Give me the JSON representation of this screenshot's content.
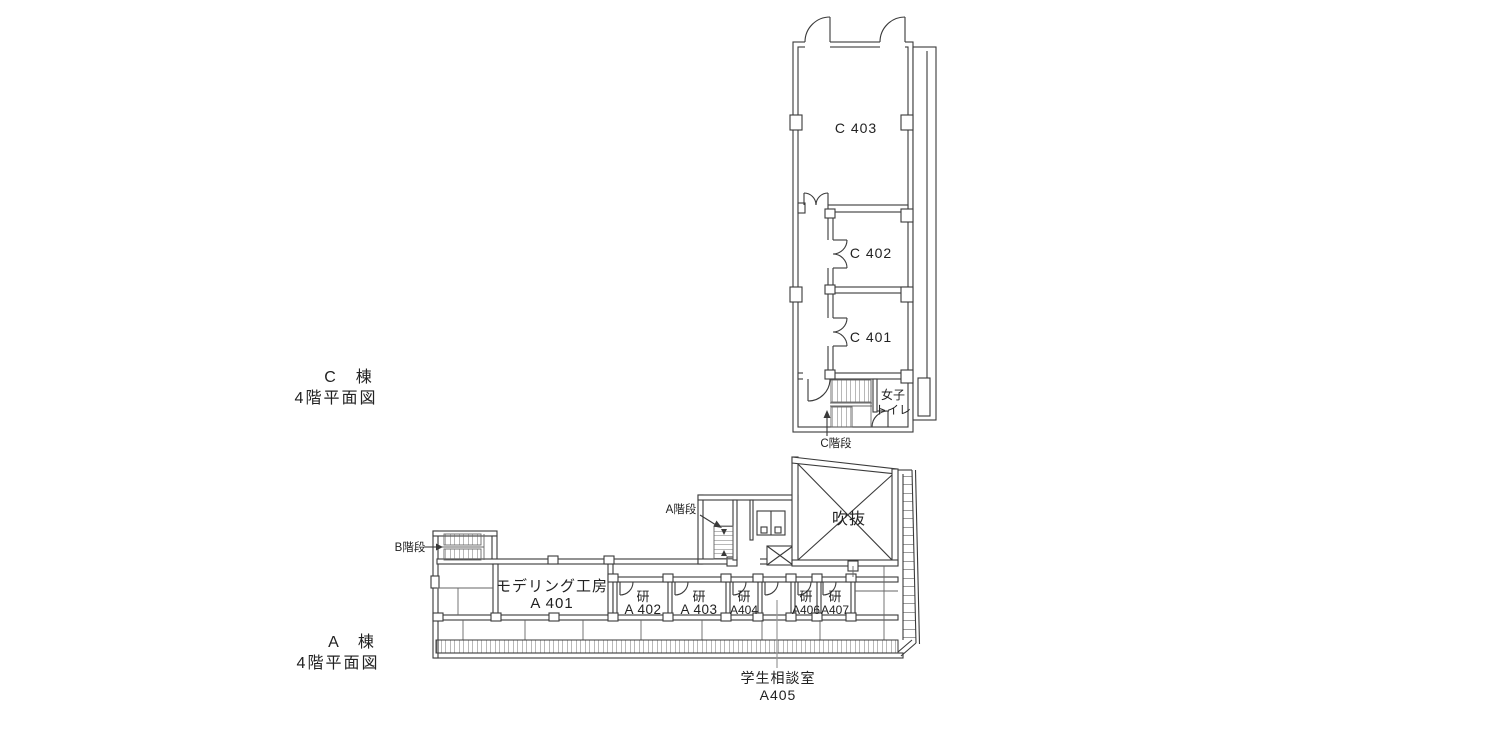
{
  "colors": {
    "background": "#ffffff",
    "wall_line": "#3a3a3a",
    "thin_line": "#666666",
    "leader_line": "#999999",
    "text": "#222222"
  },
  "c_wing": {
    "title_line1": "C　棟",
    "title_line2": "4階平面図",
    "rooms": [
      {
        "label": "C 403"
      },
      {
        "label": "C 402"
      },
      {
        "label": "C 401"
      }
    ],
    "toilet_line1": "女子",
    "toilet_line2": "トイレ",
    "stair_label": "C階段"
  },
  "a_wing": {
    "title_line1": "A　棟",
    "title_line2": "4階平面図",
    "modeling_line1": "モデリング工房",
    "modeling_line2": "A 401",
    "labs": [
      {
        "line1": "研",
        "line2": "A 402"
      },
      {
        "line1": "研",
        "line2": "A 403"
      },
      {
        "line1": "研",
        "line2": "A404"
      },
      {
        "line1": "研",
        "line2": "A406"
      },
      {
        "line1": "研",
        "line2": "A407"
      }
    ],
    "atrium": "吹抜",
    "stair_a": "A階段",
    "stair_b": "B階段",
    "counseling_line1": "学生相談室",
    "counseling_line2": "A405"
  }
}
